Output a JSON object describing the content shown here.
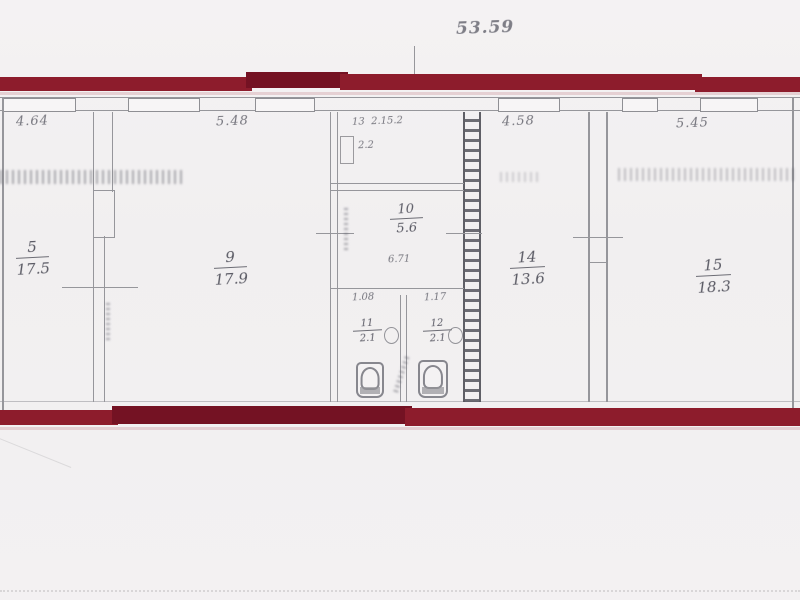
{
  "plan": {
    "overall_dim": "53.59",
    "top_dims": {
      "room5": "4.64",
      "room9": "5.48",
      "room14": "4.58",
      "room15": "5.45"
    },
    "rooms": [
      {
        "id": "5",
        "area": "17.5"
      },
      {
        "id": "9",
        "area": "17.9"
      },
      {
        "id": "10",
        "area": "5.6"
      },
      {
        "id": "11",
        "area": "2.1"
      },
      {
        "id": "12",
        "area": "2.1"
      },
      {
        "id": "14",
        "area": "13.6"
      },
      {
        "id": "15",
        "area": "18.3"
      }
    ],
    "room13": {
      "id": "13",
      "note": "2.15.2",
      "area": "2.2"
    },
    "dims": {
      "mid_width": "6.71",
      "small_left": "1.08",
      "small_right": "1.17"
    }
  },
  "colors": {
    "band": "#8d1c2c",
    "band_dark": "#741223",
    "wall": "#96969b",
    "paper": "#f3f1f2",
    "ink": "#60606a"
  }
}
